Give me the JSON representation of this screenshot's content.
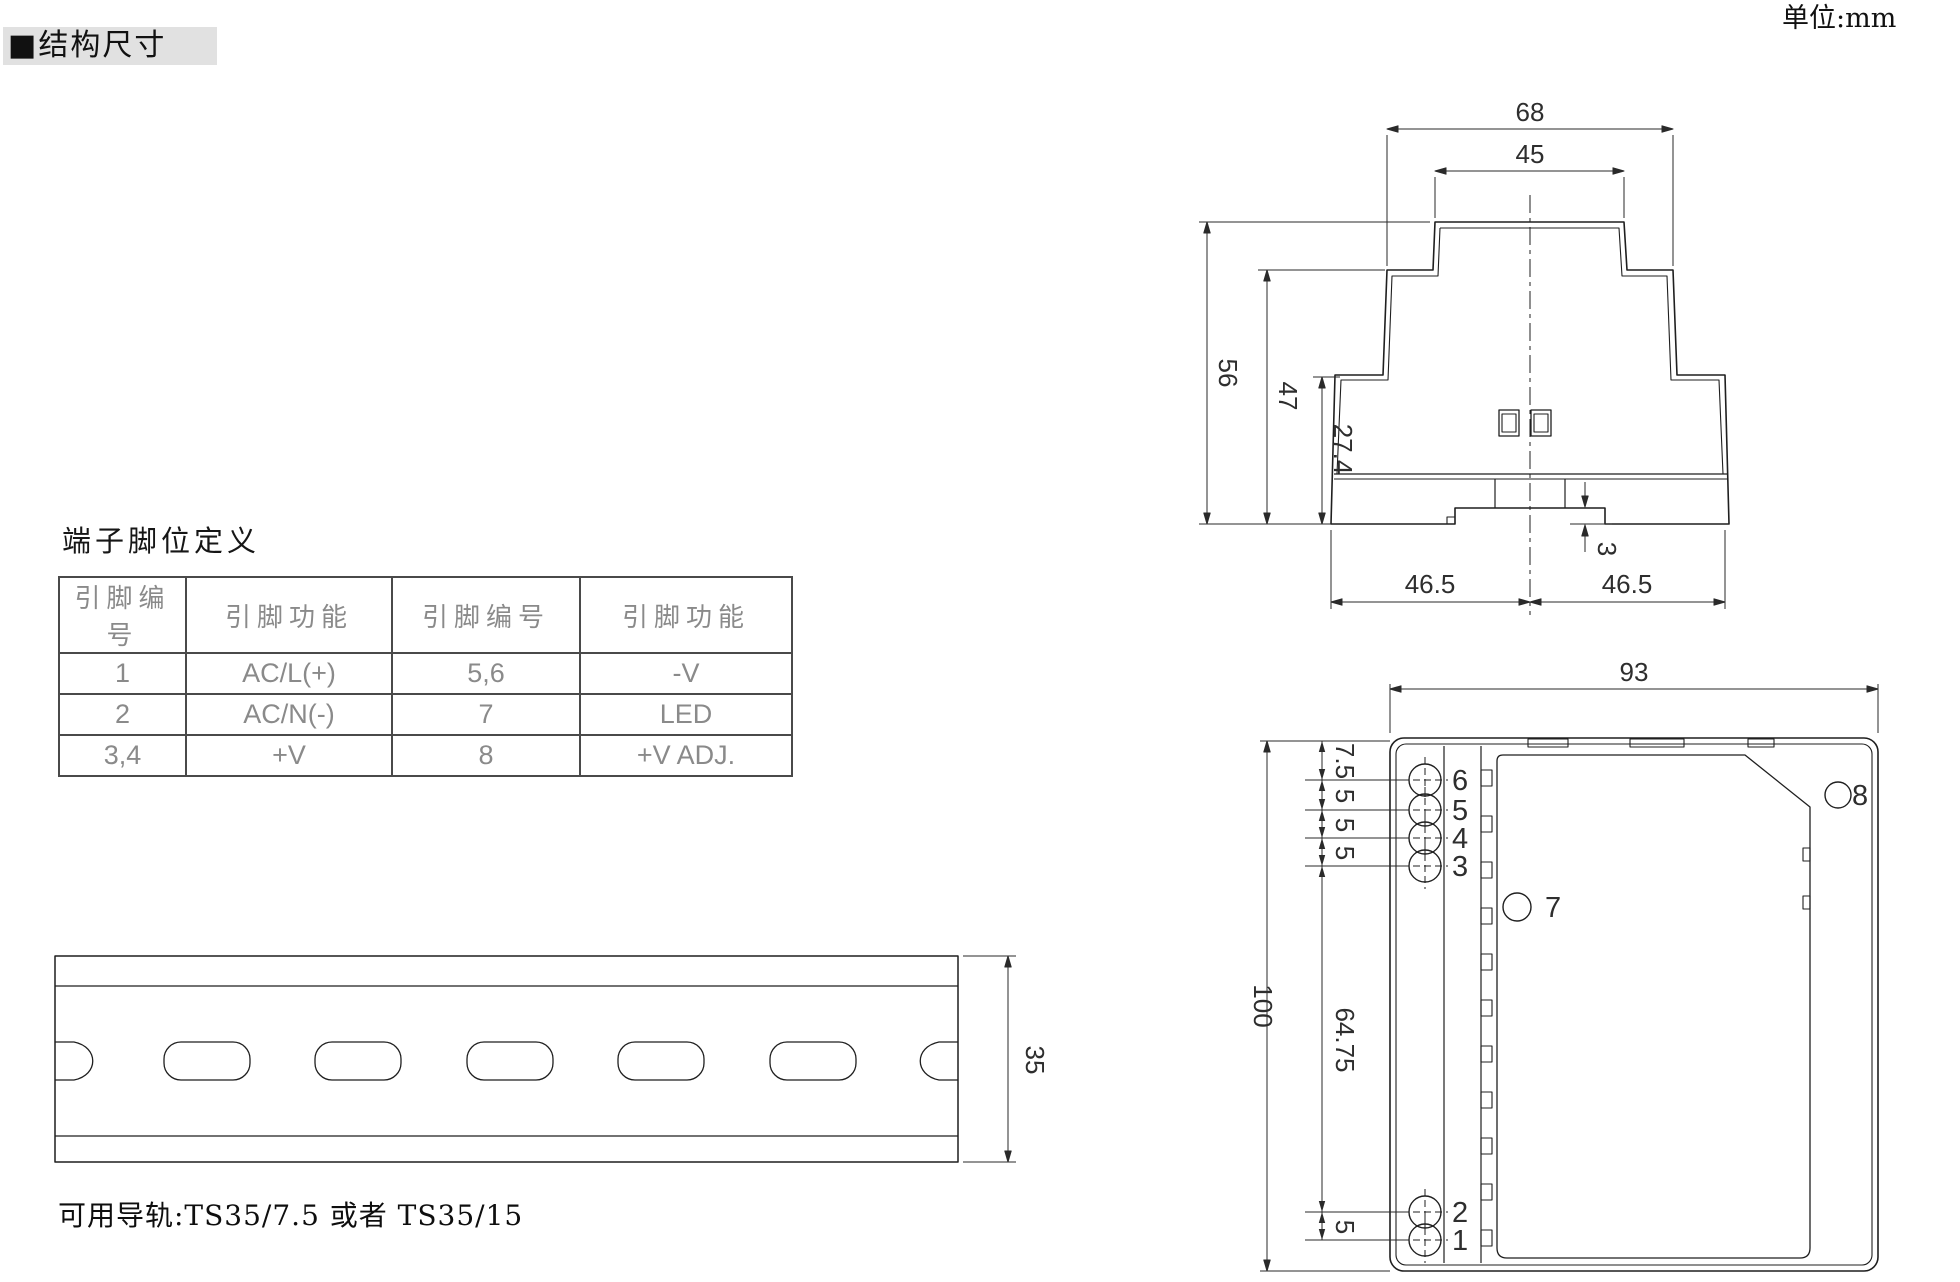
{
  "header": {
    "section_title": "■结构尺寸",
    "unit_label": "单位:mm"
  },
  "pin_table": {
    "title": "端子脚位定义",
    "headers": [
      "引脚编号",
      "引脚功能",
      "引脚编号",
      "引脚功能"
    ],
    "rows": [
      [
        "1",
        "AC/L(+)",
        "5,6",
        "-V"
      ],
      [
        "2",
        "AC/N(-)",
        "7",
        "LED"
      ],
      [
        "3,4",
        "+V",
        "8",
        "+V ADJ."
      ]
    ]
  },
  "rail": {
    "note": "可用导轨:TS35/7.5 或者 TS35/15",
    "dim_height": "35"
  },
  "top_view": {
    "dims": {
      "outer_width": "68",
      "top_width": "45",
      "total_depth": "56",
      "mid_depth": "47",
      "lower_depth": "27.4",
      "hook": "3",
      "half_left": "46.5",
      "half_right": "46.5"
    }
  },
  "front_view": {
    "dims": {
      "width": "93",
      "height": "100",
      "first_pin": "7.5",
      "pitch_a": "5",
      "pitch_b": "5",
      "pitch_c": "5",
      "mid_span": "64.75",
      "bottom_pitch": "5"
    },
    "pins": {
      "p1": "1",
      "p2": "2",
      "p3": "3",
      "p4": "4",
      "p5": "5",
      "p6": "6",
      "p7": "7",
      "p8": "8"
    }
  }
}
